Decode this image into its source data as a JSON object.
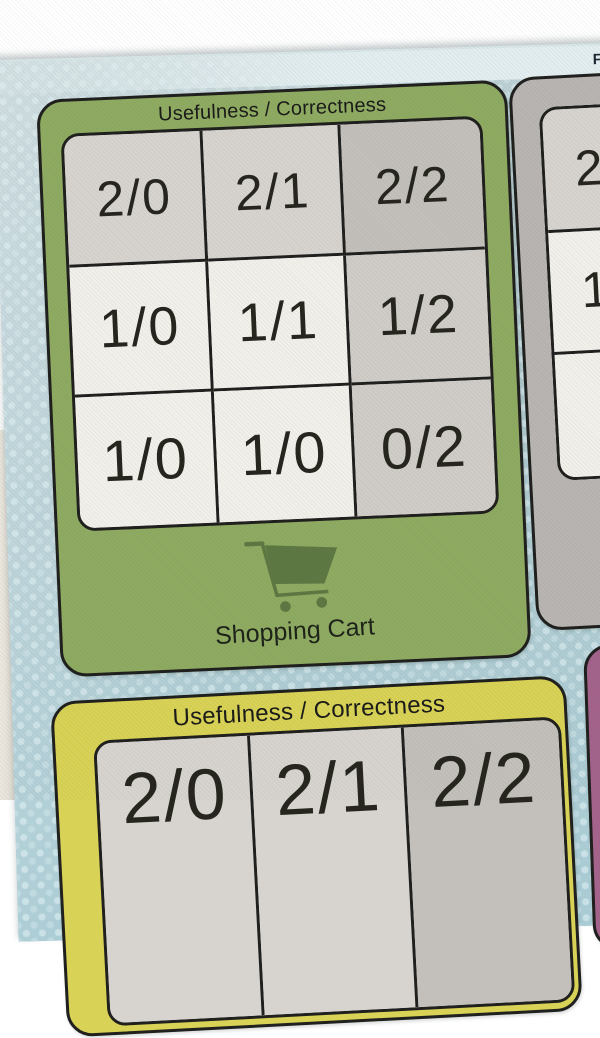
{
  "header": {
    "text": "First"
  },
  "shopping_cart_card": {
    "title": "Usefulness / Correctness",
    "grid": [
      [
        "2/0",
        "2/1",
        "2/2"
      ],
      [
        "1/0",
        "1/1",
        "1/2"
      ],
      [
        "1/0",
        "1/0",
        "0/2"
      ]
    ],
    "icon": "shopping-cart-icon",
    "label": "Shopping Cart"
  },
  "right_partial_card": {
    "visible_cells": [
      "2/",
      "1",
      ""
    ]
  },
  "bottom_partial_card": {
    "title": "Usefulness / Correctness",
    "visible_row": [
      "2/0",
      "2/1",
      "2/2"
    ]
  },
  "colors": {
    "paper_blue": "#b2cbd1",
    "paper_dots": "#cfe4e7",
    "header_band": "#e3eef0",
    "green_card": "#8fab62",
    "cart_icon_green": "#5e7843",
    "gray_card": "#b8b5b2",
    "yellow_card": "#d8d256",
    "purple_card": "#a3638b",
    "cell_white": "#f2f0eb",
    "cell_light_gray": "#d7d4d0",
    "cell_mid_gray": "#d0cdc8",
    "cell_dark_gray": "#c3c0bb",
    "outline_black": "#20201e"
  }
}
